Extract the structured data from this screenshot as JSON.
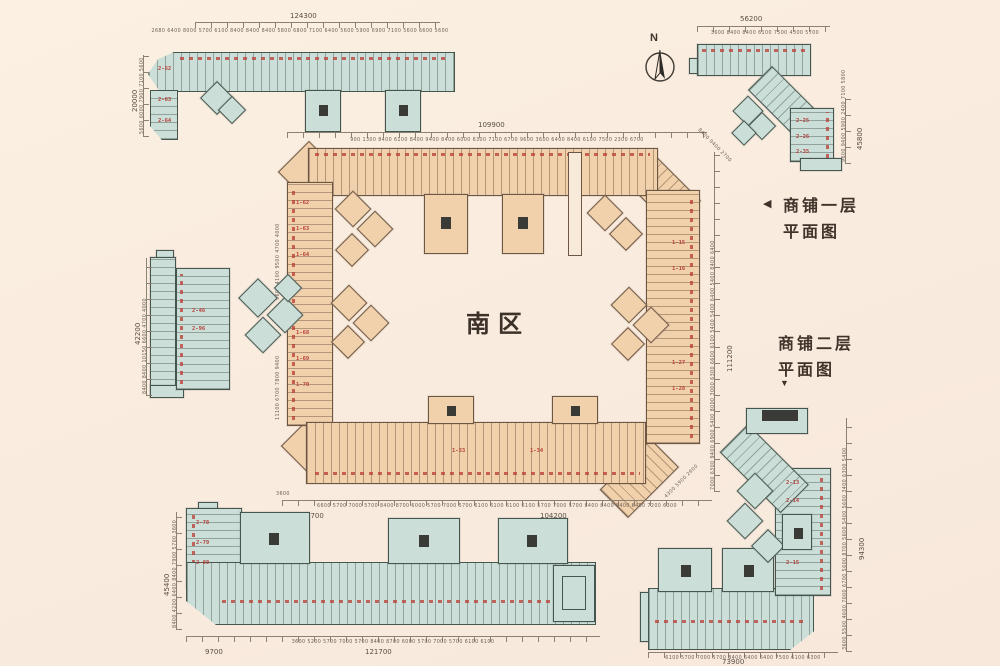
{
  "page": {
    "background": "#f9ebde"
  },
  "north": {
    "label": "N"
  },
  "center_zone": {
    "label": "南区"
  },
  "legend": {
    "floor1": {
      "arrow": "◀",
      "line1": "商铺一层",
      "line2": "平面图"
    },
    "floor2": {
      "line1": "商铺二层",
      "line2": "平面图",
      "arrow": "▼"
    }
  },
  "dims": {
    "top_left": {
      "total": "124300",
      "subs": "2680 6400 8000 5700 6100 8400 8400 8400 5800 6800 7100 6400 5600 5900 6900 7100 5600 6600 5600",
      "side_total": "20000",
      "side_subs": "5600 6000 7900 7100 5600"
    },
    "top_right": {
      "total": "56200",
      "subs": "3600 8400 8400 6100 7500 4300 5700",
      "side_total": "45800",
      "side_subs": "9600 9400 5900 2400 7100 5800"
    },
    "central_top": {
      "total": "109900",
      "subs": "900 1300 8400 6100 8400 9400 8400 6000 6300 7100 6700 9600 3600 6400 8400 6100 7500 2300 6700"
    },
    "central_bottom": {
      "total": "104200",
      "left": "3700",
      "first": "3600",
      "subs": "6600 5700 7000 5700 8400 8700 6000 5700 7000 5700 6100 6100 6100 6100 5700 7000 5700 8400 8400 8400 6400 7200 6300"
    },
    "central_right": {
      "total": "111200",
      "subs": "7000 6300 9400 6900 5400 8000 3000 6300 6600 6100 5400 5400 6400 5400 8400 6400"
    },
    "central_left_upper": "9600 4100 9500 4700 4000",
    "central_left_lower": "11100 6700 7800 9400",
    "central_diag_tr": "8400 9400 2700",
    "central_diag_br": "4300 5900 2600",
    "mid_left": {
      "total": "42200",
      "subs": "8400 8400 10150 6600 4700 4000"
    },
    "bottom_left": {
      "total": "121700",
      "left_total": "9700",
      "subs": "3600 5200 5700 7000 5700 8400 8700 6000 5700 7000 5700 6100 6100",
      "side_total": "45400",
      "side_subs": "8400 4200 6400 8400 7900 5700 3600"
    },
    "bottom_right": {
      "total": "73900",
      "subs": "6100 5700 7000 5700 8400 6400 6400 7500 6100 6300",
      "side_total": "94300",
      "side_subs": "3600 5500 4600 7000 6700 5600 8700 5600 5400 5600 3400 6300 5400"
    }
  },
  "units": {
    "central": [
      "1-62",
      "1-63",
      "1-64",
      "1-68",
      "1-69",
      "1-70",
      "1-15",
      "1-16",
      "1-27",
      "1-28",
      "1-33",
      "1-34"
    ],
    "top_left": [
      "2-62",
      "2-63",
      "2-64"
    ],
    "top_right": [
      "2-25",
      "2-26",
      "2-35"
    ],
    "mid_left": [
      "2-46",
      "2-96"
    ],
    "bottom_left": [
      "2-78",
      "2-79",
      "2-80"
    ],
    "bottom_right": [
      "2-13",
      "2-14",
      "2-15"
    ]
  }
}
